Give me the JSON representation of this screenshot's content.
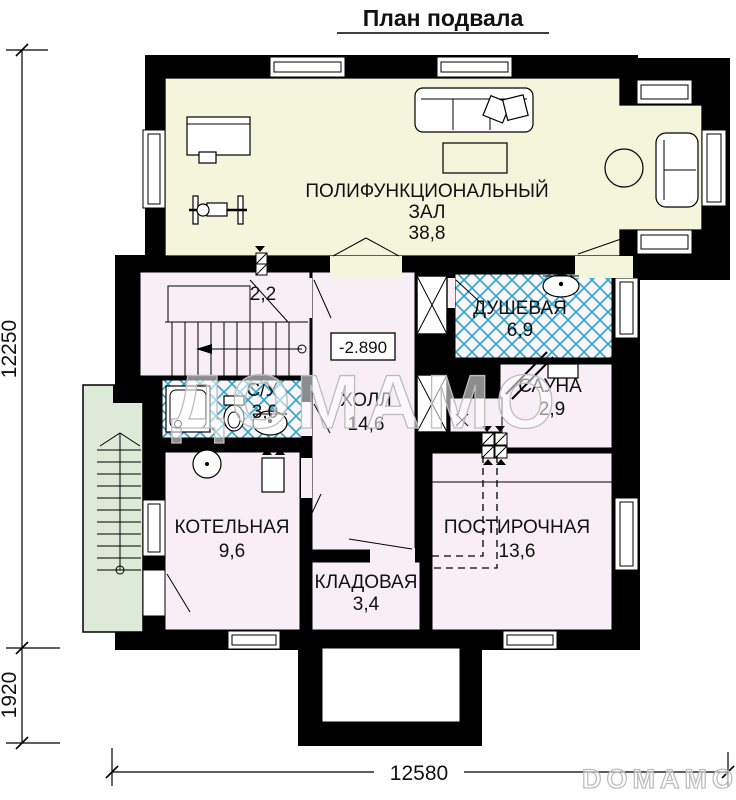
{
  "title": "План подвала",
  "rooms": {
    "multifunction_hall": {
      "name_line1": "ПОЛИФУНКЦИОНАЛЬНЫЙ",
      "name_line2": "ЗАЛ",
      "area": "38,8"
    },
    "stairwell": {
      "area": "2,2"
    },
    "shower_room": {
      "name": "ДУШЕВАЯ",
      "area": "6,9"
    },
    "sauna": {
      "name": "САУНА",
      "area": "2,9"
    },
    "wc": {
      "name": "С/У",
      "area": "3,0"
    },
    "hall": {
      "name": "ХОЛЛ",
      "area": "14,6"
    },
    "boiler_room": {
      "name": "КОТЕЛЬНАЯ",
      "area": "9,6"
    },
    "storage": {
      "name": "КЛАДОВАЯ",
      "area": "3,4"
    },
    "laundry": {
      "name": "ПОСТИРОЧНАЯ",
      "area": "13,6"
    }
  },
  "elevation_mark": "-2.890",
  "dimensions": {
    "left_total": "12250",
    "left_porch": "1920",
    "bottom_total": "12580"
  },
  "watermarks": {
    "center": "ДОМАМО",
    "corner": "DOMAMO"
  },
  "colors": {
    "wall": "#000000",
    "hall_fill": "#f3f6da",
    "room_fill": "#f8eef5",
    "exterior_stairs_fill": "#dcead7",
    "wet_room_hatch": "#2aa7c9",
    "label_blue": "#1ea4c8"
  }
}
